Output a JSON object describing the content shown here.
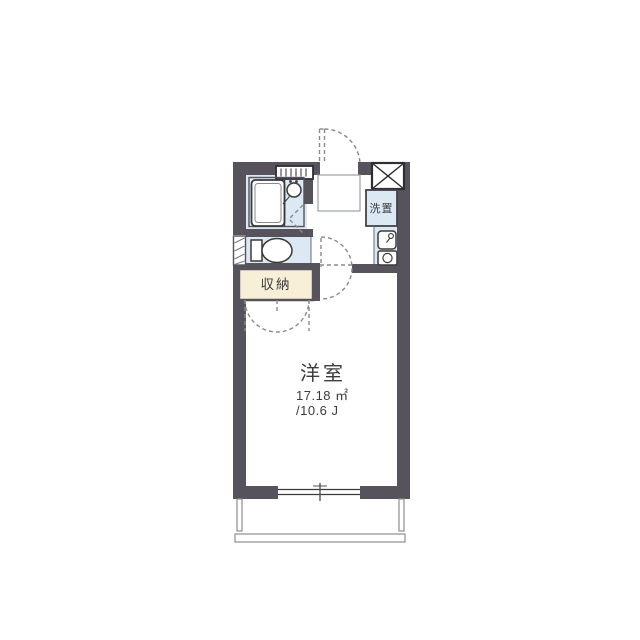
{
  "plan": {
    "rooms": {
      "main": {
        "name": "洋室",
        "area": "17.18 ㎡",
        "tatami": "/10.6 J"
      },
      "closet": {
        "name": "収納"
      },
      "laundry": {
        "name": "洗置"
      }
    },
    "icons": [
      "meter-box-icon",
      "vent-shelf-icon",
      "bathtub-icon",
      "washbasin-icon",
      "toilet-icon",
      "kitchen-sink-icon",
      "stove-burner-icon",
      "entrance-door-arc-icon",
      "room-door-arc-icon",
      "closet-doors-arc-icon",
      "folding-door-icon",
      "sliding-window-icon",
      "balcony-rail-icon",
      "hatched-window-icon"
    ]
  },
  "colors": {
    "wall": "#56535C",
    "wet": "#DCE9F5",
    "closet_fill": "#F8EFD8",
    "line": "#3A3A3A",
    "dash": "#8A8A8A",
    "balcony": "#8E8E8E",
    "text": "#3C3C3C"
  }
}
